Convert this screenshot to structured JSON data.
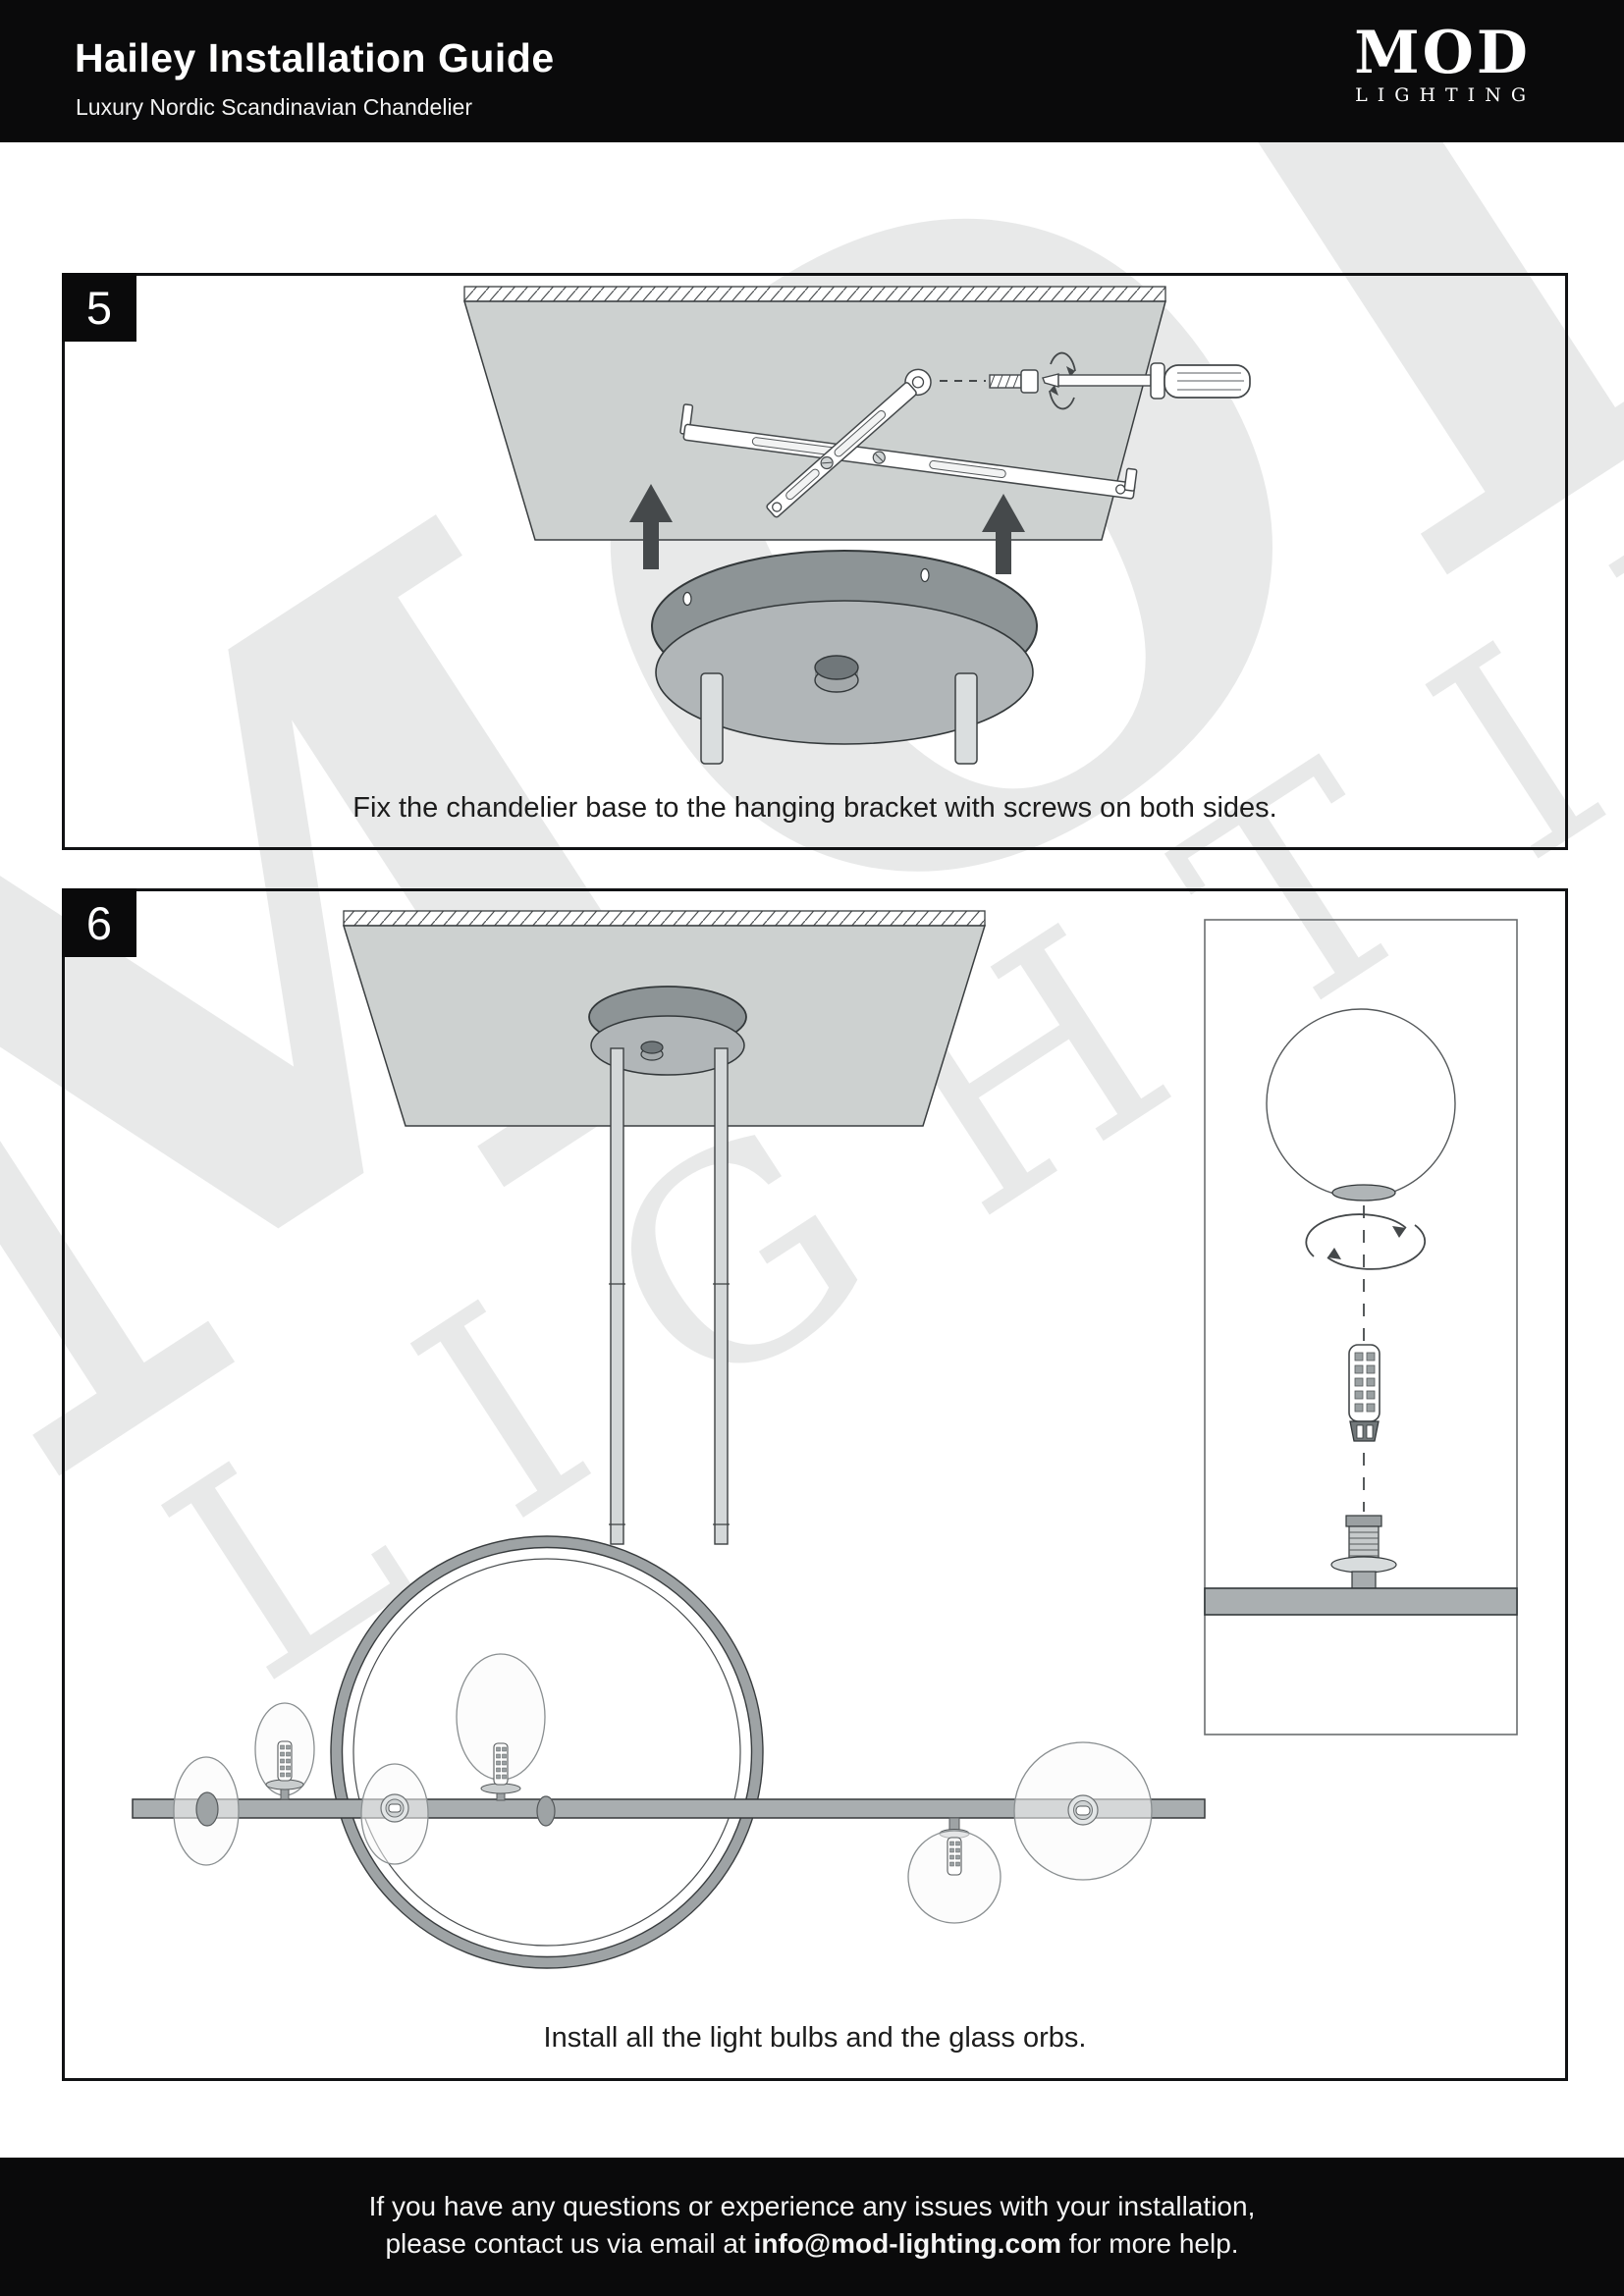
{
  "header": {
    "title": "Hailey Installation Guide",
    "subtitle": "Luxury Nordic Scandinavian Chandelier",
    "logo": {
      "name": "MOD",
      "tagline": "LIGHTING"
    }
  },
  "steps": [
    {
      "number": "5",
      "caption": "Fix the chandelier base to the hanging bracket with screws on both sides."
    },
    {
      "number": "6",
      "caption": "Install all the light bulbs and the glass orbs."
    }
  ],
  "footer": {
    "line1": "If you have any questions or experience any issues with your installation,",
    "line2_prefix": "please contact us via email at ",
    "email": "info@mod-lighting.com",
    "line2_suffix": " for more help."
  },
  "watermark": {
    "line1": "MOD",
    "line2": "LIGHTING"
  },
  "colors": {
    "header_bg": "#0a0a0b",
    "ceiling_panel": "#cdd1d0",
    "canopy_dark": "#8d9496",
    "canopy_light": "#b1b6b8",
    "metal_gray": "#a9aeb0",
    "ring_gray": "#9ea3a5",
    "arrow_dark": "#45494b",
    "caption_text": "#1c1c1c"
  }
}
